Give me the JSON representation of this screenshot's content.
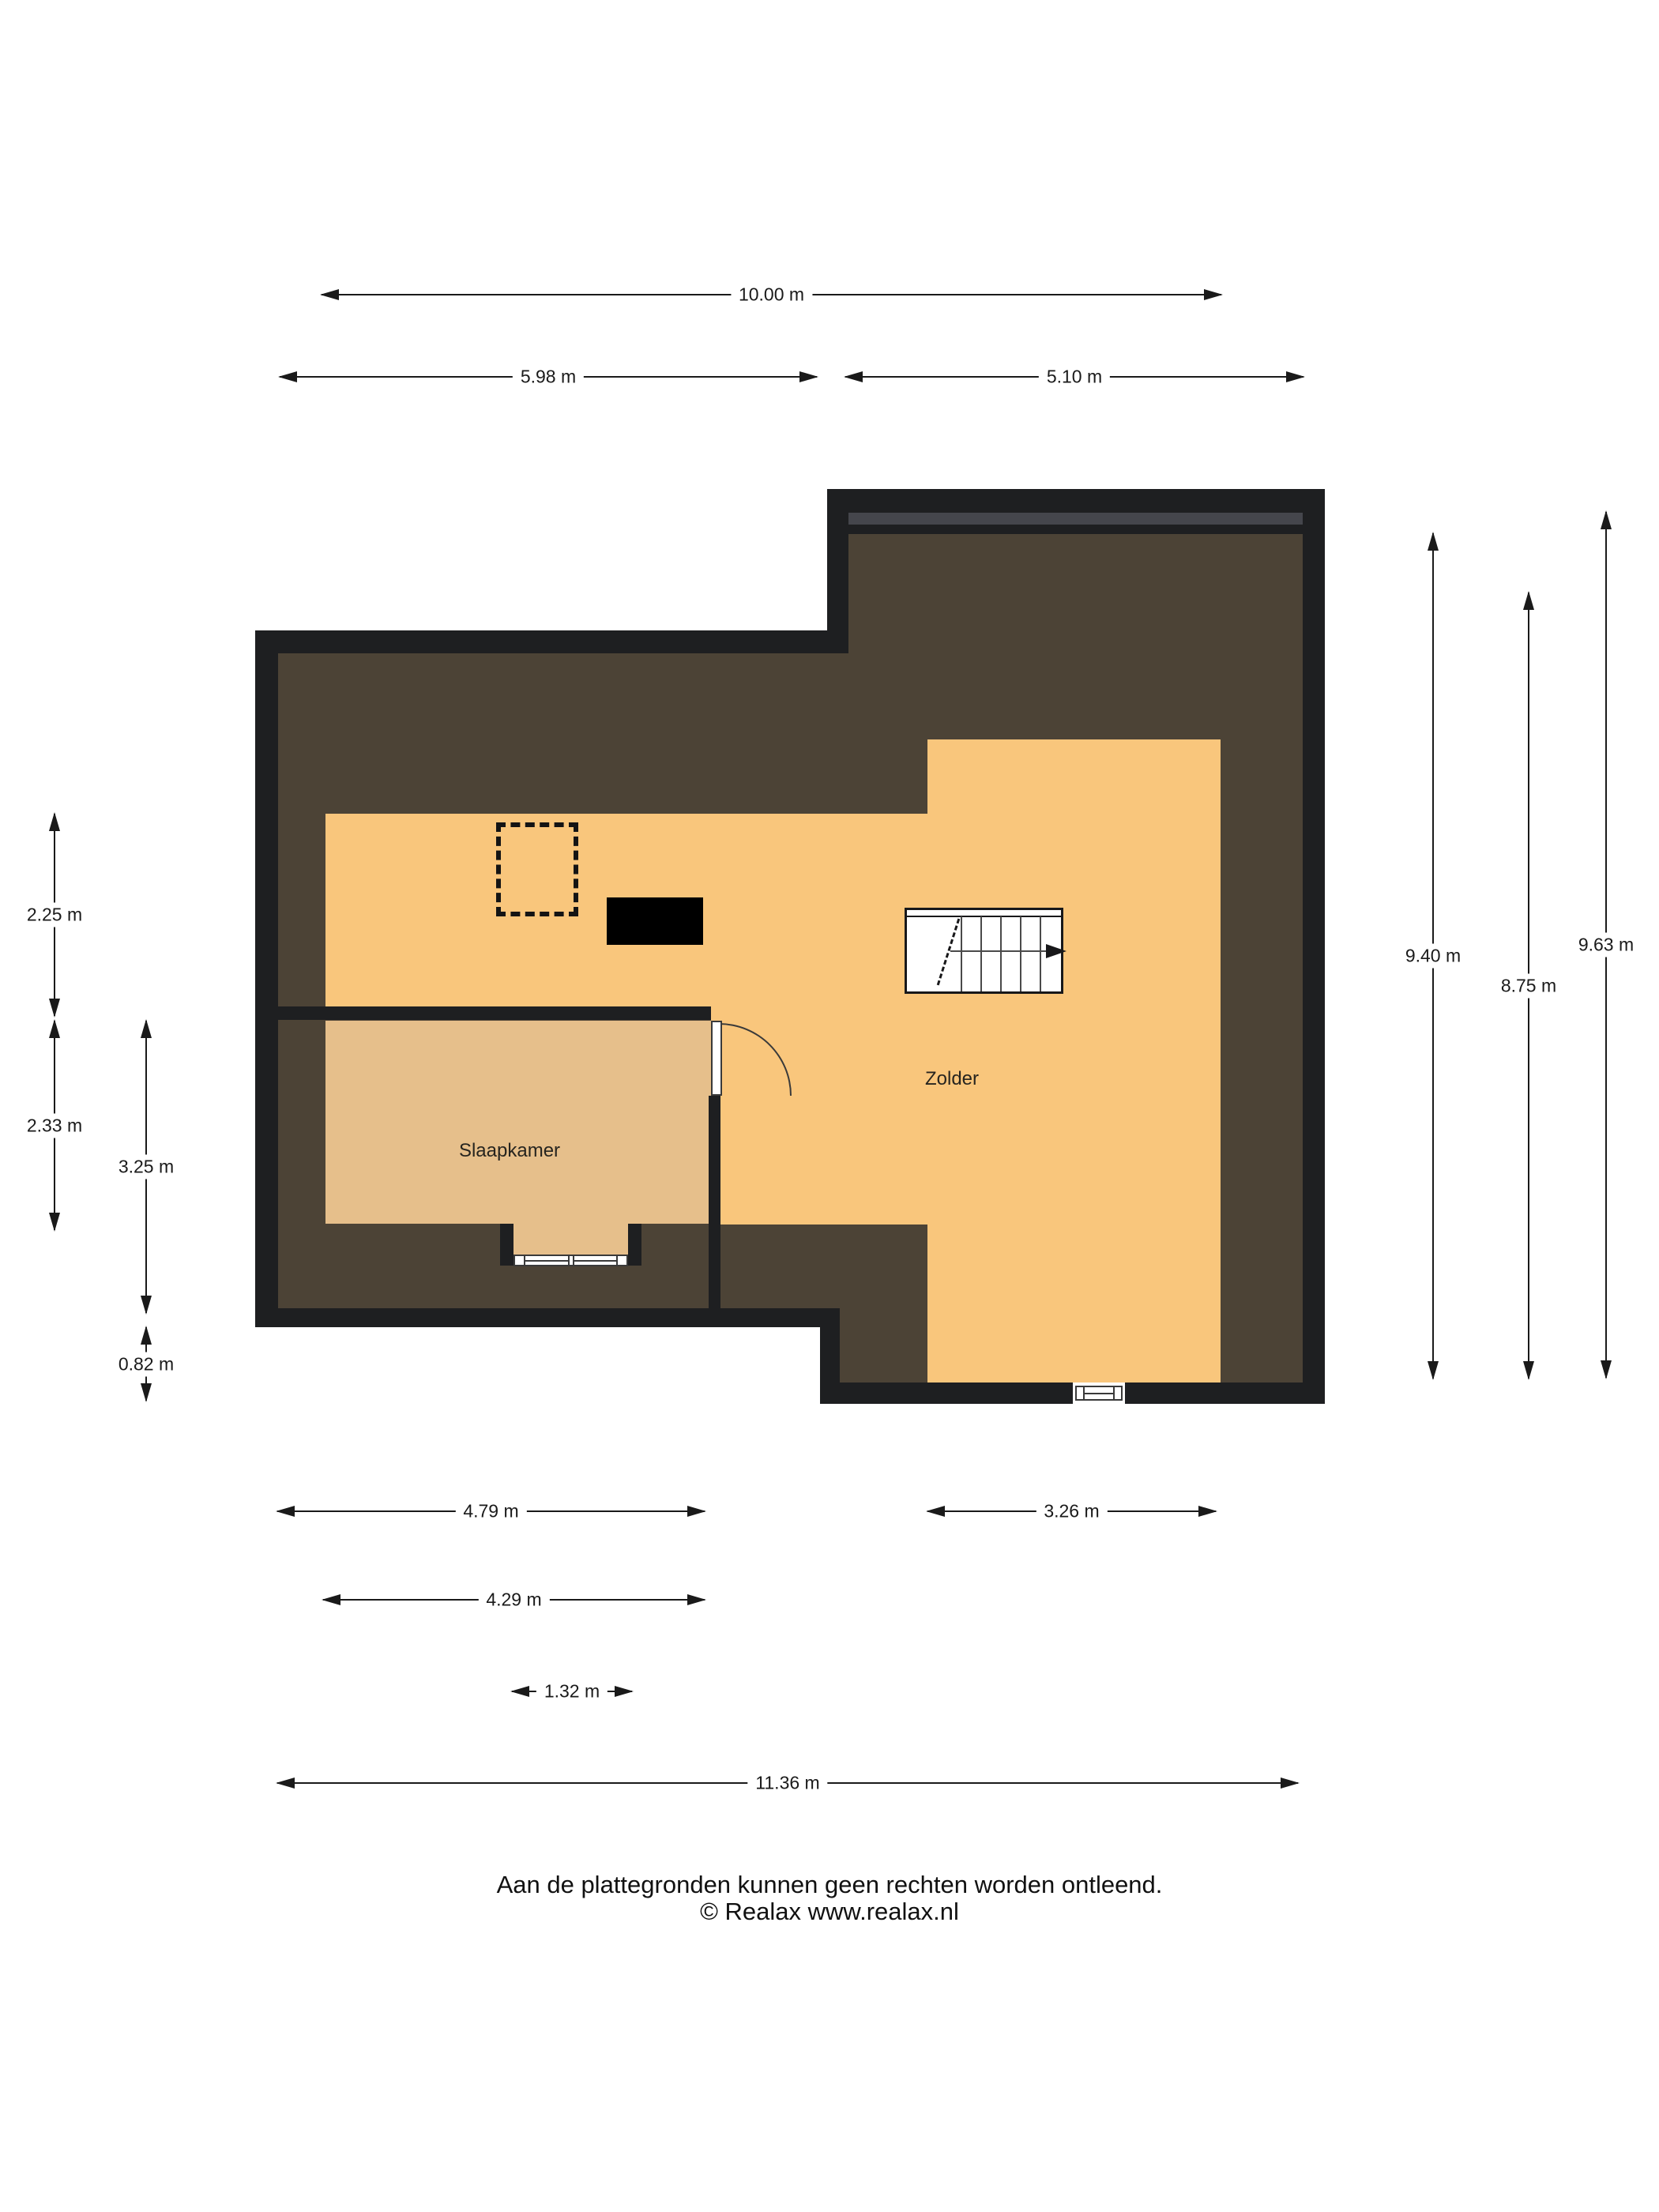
{
  "title": "Floor plan attic (plattegrond zolderverdieping)",
  "rooms": [
    {
      "name": "Zolder"
    },
    {
      "name": "Slaapkamer"
    }
  ],
  "dimensions": {
    "top": [
      {
        "label": "10.00 m"
      },
      {
        "label": "5.98 m"
      },
      {
        "label": "5.10 m"
      }
    ],
    "left": [
      {
        "label": "2.25 m"
      },
      {
        "label": "2.33 m"
      },
      {
        "label": "3.25 m"
      },
      {
        "label": "0.82 m"
      }
    ],
    "right": [
      {
        "label": "9.40 m"
      },
      {
        "label": "8.75 m"
      },
      {
        "label": "9.63 m"
      }
    ],
    "bottom": [
      {
        "label": "4.79 m"
      },
      {
        "label": "3.26 m"
      },
      {
        "label": "4.29 m"
      },
      {
        "label": "1.32 m"
      },
      {
        "label": "11.36 m"
      }
    ]
  },
  "footer": {
    "line1": "Aan de plattegronden kunnen geen rechten worden ontleend.",
    "line2": "© Realax www.realax.nl"
  },
  "colors": {
    "wall": "#1e1f21",
    "roof_area": "#4c4336",
    "zolder_floor": "#f9c67c",
    "slaapkamer_floor": "#e6bf8b",
    "roof_window_band": "#45464c",
    "dimension_line": "#1a1a1a",
    "background": "#ffffff"
  }
}
